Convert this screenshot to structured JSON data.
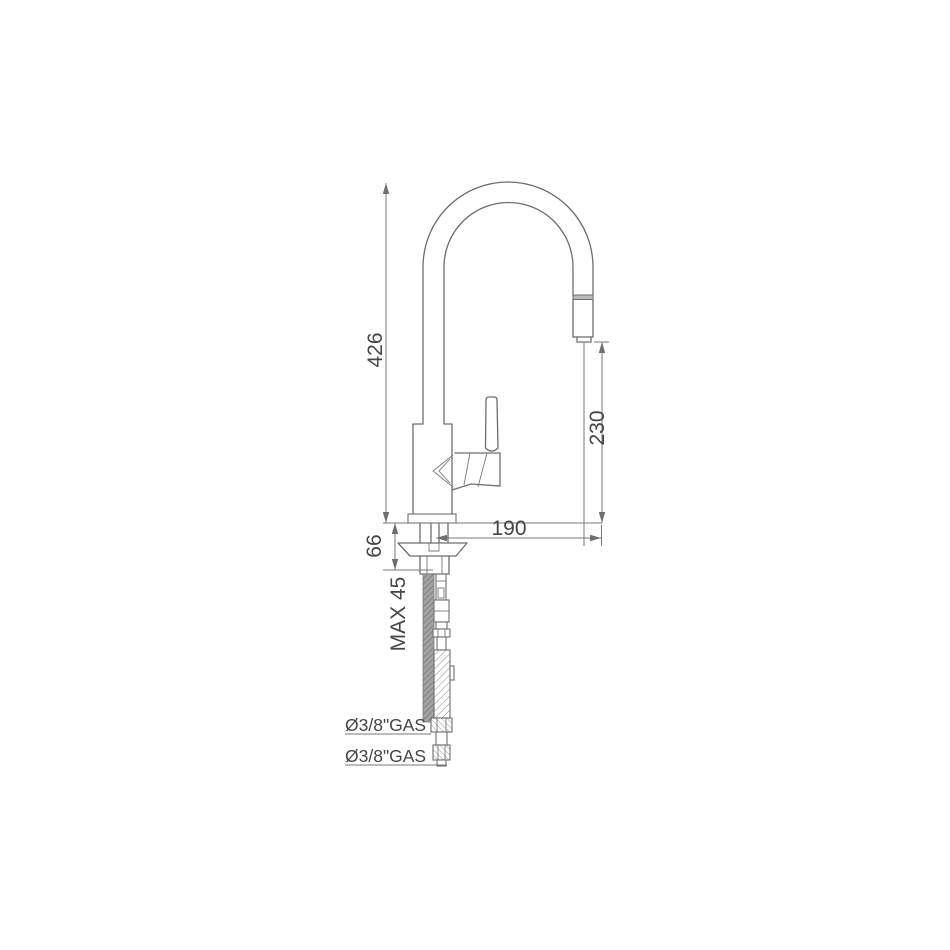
{
  "page": {
    "background": "#ffffff",
    "line_color": "#6e6e6e",
    "text_color": "#454545",
    "band_fill": "#b9b9b9",
    "rod_fill": "#a3a3a3"
  },
  "drawing": {
    "dimensions": {
      "total_height": "426",
      "outlet_height": "230",
      "spout_reach": "190",
      "shank_length": "66",
      "max_deck_thickness": "MAX 45"
    },
    "connections": [
      "Ø3/8\"GAS",
      "Ø3/8\"GAS"
    ]
  }
}
